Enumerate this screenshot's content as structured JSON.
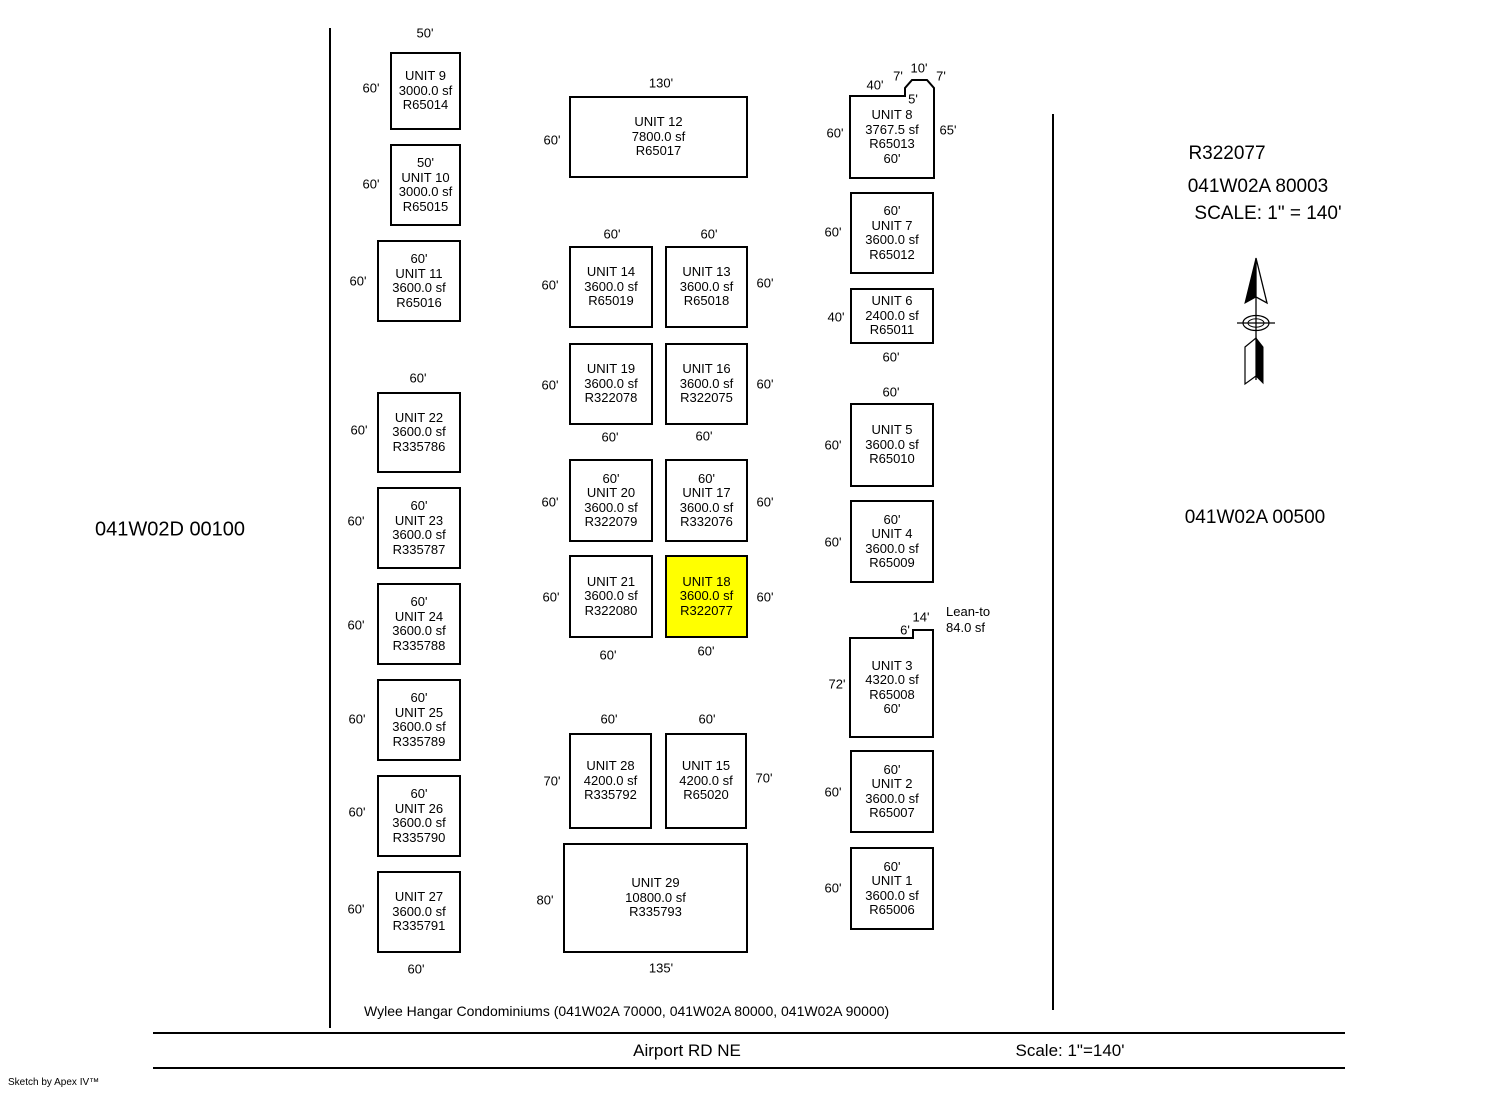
{
  "page": {
    "left_parcel_label": "041W02D 00100",
    "right_panel": {
      "ref": "R322077",
      "parcel": "041W02A 80003",
      "scale": "SCALE: 1\" = 140'"
    },
    "right_parcel_label": "041W02A 00500",
    "annotation": {
      "line1": "Lean-to",
      "line2": "84.0 sf"
    },
    "footer": {
      "condo_note": "Wylee Hangar Condominiums (041W02A 70000, 041W02A 80000, 041W02A 90000)",
      "road": "Airport RD NE",
      "scale": "Scale: 1\"=140'",
      "credit": "Sketch by Apex IV™"
    },
    "highlight_color": "#FFFF00"
  },
  "units": [
    {
      "id": "unit-9",
      "box": {
        "x": 390,
        "y": 52,
        "w": 71,
        "h": 78
      },
      "lines": [
        "UNIT 9",
        "3000.0 sf",
        "R65014"
      ]
    },
    {
      "id": "unit-10",
      "box": {
        "x": 390,
        "y": 144,
        "w": 71,
        "h": 82
      },
      "lines": [
        "50'",
        "UNIT 10",
        "3000.0 sf",
        "R65015"
      ]
    },
    {
      "id": "unit-11",
      "box": {
        "x": 377,
        "y": 240,
        "w": 84,
        "h": 82
      },
      "lines": [
        "60'",
        "UNIT 11",
        "3600.0 sf",
        "R65016"
      ]
    },
    {
      "id": "unit-22",
      "box": {
        "x": 377,
        "y": 392,
        "w": 84,
        "h": 81
      },
      "lines": [
        "UNIT 22",
        "3600.0 sf",
        "R335786"
      ]
    },
    {
      "id": "unit-23",
      "box": {
        "x": 377,
        "y": 487,
        "w": 84,
        "h": 82
      },
      "lines": [
        "60'",
        "UNIT 23",
        "3600.0 sf",
        "R335787"
      ]
    },
    {
      "id": "unit-24",
      "box": {
        "x": 377,
        "y": 583,
        "w": 84,
        "h": 82
      },
      "lines": [
        "60'",
        "UNIT 24",
        "3600.0 sf",
        "R335788"
      ]
    },
    {
      "id": "unit-25",
      "box": {
        "x": 377,
        "y": 679,
        "w": 84,
        "h": 82
      },
      "lines": [
        "60'",
        "UNIT 25",
        "3600.0 sf",
        "R335789"
      ]
    },
    {
      "id": "unit-26",
      "box": {
        "x": 377,
        "y": 775,
        "w": 84,
        "h": 82
      },
      "lines": [
        "60'",
        "UNIT 26",
        "3600.0 sf",
        "R335790"
      ]
    },
    {
      "id": "unit-27",
      "box": {
        "x": 377,
        "y": 871,
        "w": 84,
        "h": 82
      },
      "lines": [
        "UNIT 27",
        "3600.0 sf",
        "R335791"
      ]
    },
    {
      "id": "unit-12",
      "box": {
        "x": 569,
        "y": 96,
        "w": 179,
        "h": 82
      },
      "lines": [
        "UNIT 12",
        "7800.0 sf",
        "R65017"
      ]
    },
    {
      "id": "unit-14",
      "box": {
        "x": 569,
        "y": 246,
        "w": 84,
        "h": 82
      },
      "lines": [
        "UNIT 14",
        "3600.0 sf",
        "R65019"
      ]
    },
    {
      "id": "unit-13",
      "box": {
        "x": 665,
        "y": 246,
        "w": 83,
        "h": 82
      },
      "lines": [
        "UNIT 13",
        "3600.0 sf",
        "R65018"
      ]
    },
    {
      "id": "unit-19",
      "box": {
        "x": 569,
        "y": 343,
        "w": 84,
        "h": 82
      },
      "lines": [
        "UNIT 19",
        "3600.0 sf",
        "R322078"
      ]
    },
    {
      "id": "unit-16",
      "box": {
        "x": 665,
        "y": 343,
        "w": 83,
        "h": 82
      },
      "lines": [
        "UNIT 16",
        "3600.0 sf",
        "R322075"
      ]
    },
    {
      "id": "unit-20",
      "box": {
        "x": 569,
        "y": 459,
        "w": 84,
        "h": 83
      },
      "lines": [
        "60'",
        "UNIT 20",
        "3600.0 sf",
        "R322079"
      ]
    },
    {
      "id": "unit-17",
      "box": {
        "x": 665,
        "y": 459,
        "w": 83,
        "h": 83
      },
      "lines": [
        "60'",
        "UNIT 17",
        "3600.0 sf",
        "R332076"
      ]
    },
    {
      "id": "unit-21",
      "box": {
        "x": 569,
        "y": 555,
        "w": 84,
        "h": 83
      },
      "lines": [
        "UNIT 21",
        "3600.0 sf",
        "R322080"
      ]
    },
    {
      "id": "unit-18",
      "box": {
        "x": 665,
        "y": 555,
        "w": 83,
        "h": 83
      },
      "fill": "#FFFF00",
      "lines": [
        "UNIT 18",
        "3600.0 sf",
        "R322077"
      ]
    },
    {
      "id": "unit-28",
      "box": {
        "x": 569,
        "y": 733,
        "w": 83,
        "h": 96
      },
      "lines": [
        "UNIT 28",
        "4200.0 sf",
        "R335792"
      ]
    },
    {
      "id": "unit-15",
      "box": {
        "x": 665,
        "y": 733,
        "w": 82,
        "h": 96
      },
      "lines": [
        "UNIT 15",
        "4200.0 sf",
        "R65020"
      ]
    },
    {
      "id": "unit-29",
      "box": {
        "x": 563,
        "y": 843,
        "w": 185,
        "h": 110
      },
      "lines": [
        "UNIT 29",
        "10800.0 sf",
        "R335793"
      ]
    },
    {
      "id": "unit-8",
      "polygon": [
        [
          850,
          96
        ],
        [
          905,
          96
        ],
        [
          905,
          88
        ],
        [
          912,
          80
        ],
        [
          927,
          80
        ],
        [
          934,
          88
        ],
        [
          934,
          178
        ],
        [
          850,
          178
        ]
      ],
      "box": {
        "x": 850,
        "y": 96,
        "w": 84,
        "h": 82
      },
      "lines": [
        "UNIT 8",
        "3767.5 sf",
        "R65013",
        "60'"
      ]
    },
    {
      "id": "unit-7",
      "box": {
        "x": 850,
        "y": 192,
        "w": 84,
        "h": 82
      },
      "lines": [
        "60'",
        "UNIT 7",
        "3600.0 sf",
        "R65012"
      ]
    },
    {
      "id": "unit-6",
      "box": {
        "x": 850,
        "y": 288,
        "w": 84,
        "h": 56
      },
      "lines": [
        "UNIT 6",
        "2400.0 sf",
        "R65011"
      ]
    },
    {
      "id": "unit-5",
      "box": {
        "x": 850,
        "y": 403,
        "w": 84,
        "h": 84
      },
      "lines": [
        "UNIT 5",
        "3600.0 sf",
        "R65010"
      ]
    },
    {
      "id": "unit-4",
      "box": {
        "x": 850,
        "y": 500,
        "w": 84,
        "h": 83
      },
      "lines": [
        "60'",
        "UNIT 4",
        "3600.0 sf",
        "R65009"
      ]
    },
    {
      "id": "unit-3",
      "polygon": [
        [
          850,
          638
        ],
        [
          913,
          638
        ],
        [
          913,
          630
        ],
        [
          933,
          630
        ],
        [
          933,
          737
        ],
        [
          850,
          737
        ]
      ],
      "box": {
        "x": 850,
        "y": 638,
        "w": 84,
        "h": 99
      },
      "lines": [
        "UNIT 3",
        "4320.0 sf",
        "R65008",
        "60'"
      ]
    },
    {
      "id": "unit-2",
      "box": {
        "x": 850,
        "y": 750,
        "w": 84,
        "h": 83
      },
      "lines": [
        "60'",
        "UNIT 2",
        "3600.0 sf",
        "R65007"
      ]
    },
    {
      "id": "unit-1",
      "box": {
        "x": 850,
        "y": 847,
        "w": 84,
        "h": 83
      },
      "lines": [
        "60'",
        "UNIT 1",
        "3600.0 sf",
        "R65006"
      ]
    }
  ],
  "dim_labels": [
    {
      "text": "50'",
      "x": 425,
      "y": 33
    },
    {
      "text": "60'",
      "x": 371,
      "y": 88
    },
    {
      "text": "60'",
      "x": 371,
      "y": 184
    },
    {
      "text": "60'",
      "x": 358,
      "y": 281
    },
    {
      "text": "60'",
      "x": 418,
      "y": 378
    },
    {
      "text": "60'",
      "x": 359,
      "y": 430
    },
    {
      "text": "60'",
      "x": 356,
      "y": 521
    },
    {
      "text": "60'",
      "x": 356,
      "y": 625
    },
    {
      "text": "60'",
      "x": 357,
      "y": 719
    },
    {
      "text": "60'",
      "x": 357,
      "y": 812
    },
    {
      "text": "60'",
      "x": 356,
      "y": 909
    },
    {
      "text": "60'",
      "x": 416,
      "y": 969
    },
    {
      "text": "130'",
      "x": 661,
      "y": 83
    },
    {
      "text": "60'",
      "x": 552,
      "y": 140
    },
    {
      "text": "60'",
      "x": 612,
      "y": 234
    },
    {
      "text": "60'",
      "x": 709,
      "y": 234
    },
    {
      "text": "60'",
      "x": 550,
      "y": 285
    },
    {
      "text": "60'",
      "x": 765,
      "y": 283
    },
    {
      "text": "60'",
      "x": 550,
      "y": 385
    },
    {
      "text": "60'",
      "x": 765,
      "y": 384
    },
    {
      "text": "60'",
      "x": 610,
      "y": 437
    },
    {
      "text": "60'",
      "x": 704,
      "y": 436
    },
    {
      "text": "60'",
      "x": 550,
      "y": 502
    },
    {
      "text": "60'",
      "x": 765,
      "y": 502
    },
    {
      "text": "60'",
      "x": 551,
      "y": 597
    },
    {
      "text": "60'",
      "x": 765,
      "y": 597
    },
    {
      "text": "60'",
      "x": 608,
      "y": 655
    },
    {
      "text": "60'",
      "x": 706,
      "y": 651
    },
    {
      "text": "60'",
      "x": 609,
      "y": 719
    },
    {
      "text": "60'",
      "x": 707,
      "y": 719
    },
    {
      "text": "70'",
      "x": 552,
      "y": 781
    },
    {
      "text": "70'",
      "x": 764,
      "y": 778
    },
    {
      "text": "80'",
      "x": 545,
      "y": 900
    },
    {
      "text": "135'",
      "x": 661,
      "y": 968
    },
    {
      "text": "40'",
      "x": 875,
      "y": 85
    },
    {
      "text": "7'",
      "x": 898,
      "y": 76
    },
    {
      "text": "10'",
      "x": 919,
      "y": 68
    },
    {
      "text": "7'",
      "x": 941,
      "y": 76
    },
    {
      "text": "5'",
      "x": 913,
      "y": 99
    },
    {
      "text": "60'",
      "x": 835,
      "y": 133
    },
    {
      "text": "65'",
      "x": 948,
      "y": 130
    },
    {
      "text": "60'",
      "x": 833,
      "y": 232
    },
    {
      "text": "40'",
      "x": 836,
      "y": 317
    },
    {
      "text": "60'",
      "x": 891,
      "y": 357
    },
    {
      "text": "60'",
      "x": 891,
      "y": 392
    },
    {
      "text": "60'",
      "x": 833,
      "y": 445
    },
    {
      "text": "60'",
      "x": 833,
      "y": 542
    },
    {
      "text": "6'",
      "x": 905,
      "y": 630
    },
    {
      "text": "14'",
      "x": 921,
      "y": 617
    },
    {
      "text": "72'",
      "x": 837,
      "y": 684
    },
    {
      "text": "60'",
      "x": 833,
      "y": 792
    },
    {
      "text": "60'",
      "x": 833,
      "y": 888
    }
  ],
  "lines": [
    {
      "name": "left-boundary-line",
      "x": 329,
      "y": 28,
      "w": 2,
      "h": 1000
    },
    {
      "name": "right-boundary-line",
      "x": 1052,
      "y": 114,
      "w": 2,
      "h": 896
    },
    {
      "name": "road-top-line",
      "x": 153,
      "y": 1032,
      "w": 1192,
      "h": 2
    },
    {
      "name": "road-bottom-line",
      "x": 153,
      "y": 1067,
      "w": 1192,
      "h": 2
    }
  ]
}
